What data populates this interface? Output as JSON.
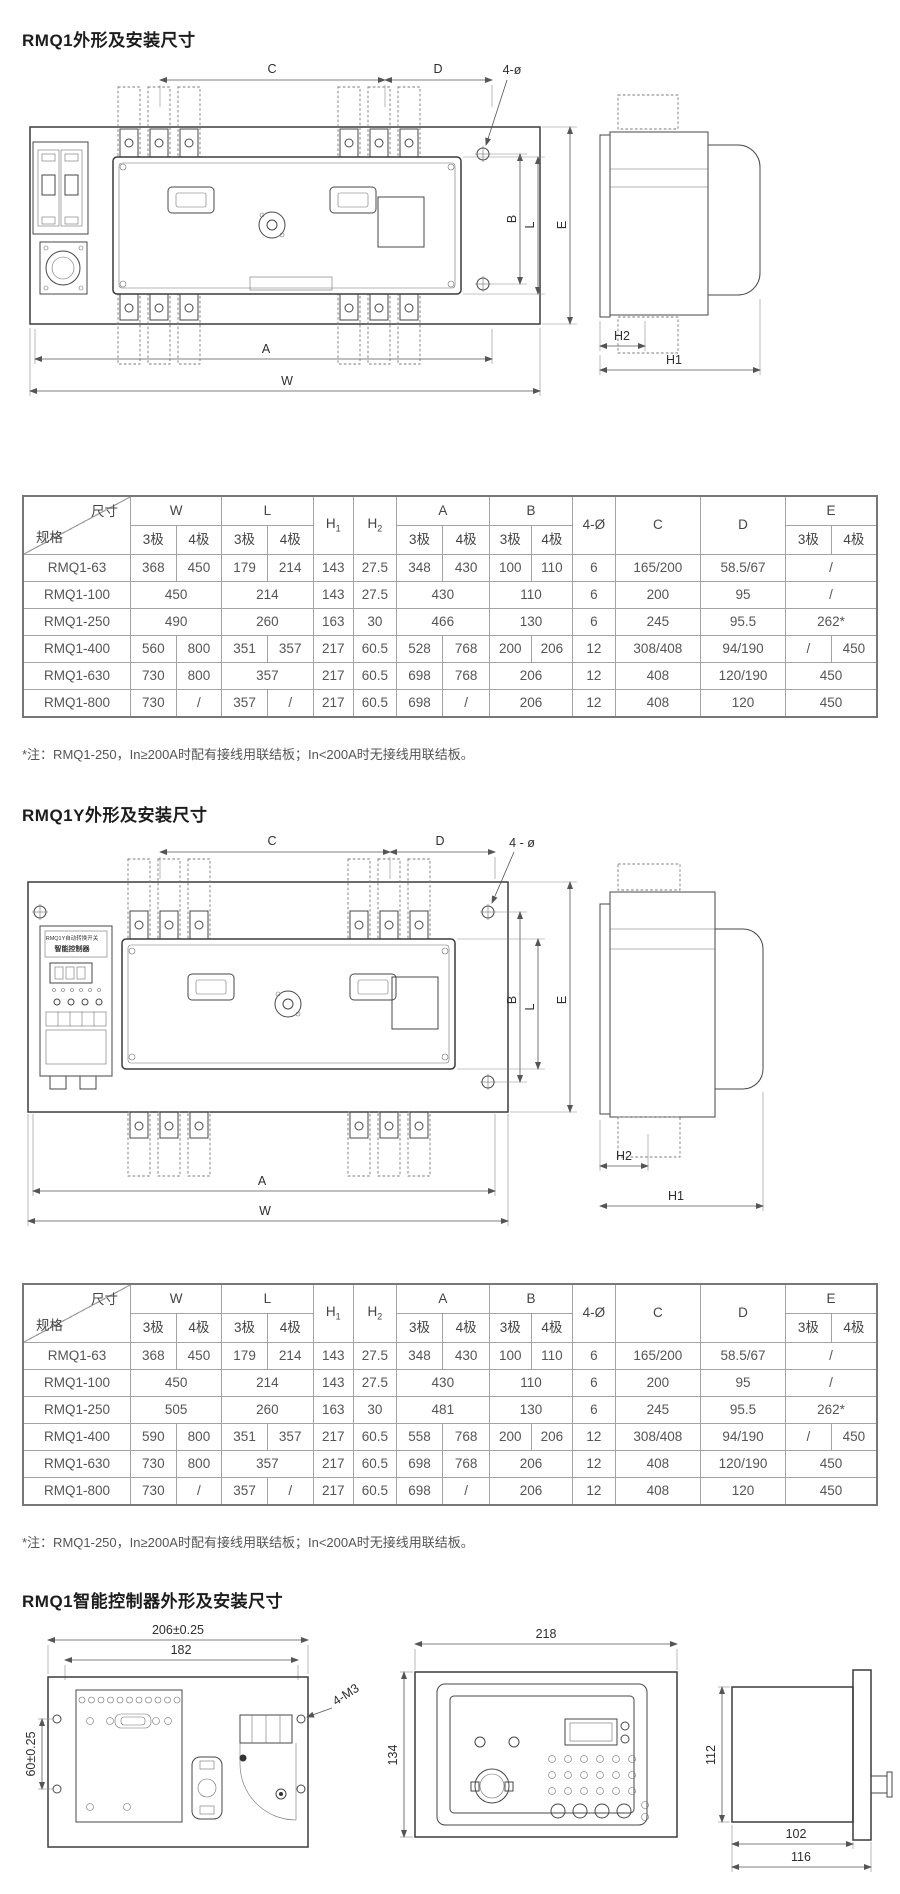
{
  "section1": {
    "title": "RMQ1外形及安装尺寸"
  },
  "section2": {
    "title": "RMQ1Y外形及安装尺寸"
  },
  "section3": {
    "title": "RMQ1智能控制器外形及安装尺寸"
  },
  "note": "*注：RMQ1-250，In≥200A时配有接线用联结板；In<200A时无接线用联结板。",
  "dim_header": {
    "corner_top": "尺寸",
    "corner_bottom": "规格",
    "w": "W",
    "l": "L",
    "h": "H",
    "h1sub": "1",
    "h2sub": "2",
    "a": "A",
    "b": "B",
    "phi": "4-Ø",
    "c": "C",
    "d": "D",
    "e": "E",
    "pole3": "3极",
    "pole4": "4极"
  },
  "tables": {
    "rmq1": {
      "rows": [
        {
          "spec": "RMQ1-63",
          "cells": [
            [
              "368",
              1
            ],
            [
              "450",
              1
            ],
            [
              "179",
              1
            ],
            [
              "214",
              1
            ],
            [
              "143",
              1
            ],
            [
              "27.5",
              1
            ],
            [
              "348",
              1
            ],
            [
              "430",
              1
            ],
            [
              "100",
              1
            ],
            [
              "110",
              1
            ],
            [
              "6",
              1
            ],
            [
              "165/200",
              1
            ],
            [
              "58.5/67",
              1
            ],
            [
              "/",
              2
            ]
          ]
        },
        {
          "spec": "RMQ1-100",
          "cells": [
            [
              "450",
              2
            ],
            [
              "214",
              2
            ],
            [
              "143",
              1
            ],
            [
              "27.5",
              1
            ],
            [
              "430",
              2
            ],
            [
              "110",
              2
            ],
            [
              "6",
              1
            ],
            [
              "200",
              1
            ],
            [
              "95",
              1
            ],
            [
              "/",
              2
            ]
          ]
        },
        {
          "spec": "RMQ1-250",
          "cells": [
            [
              "490",
              2
            ],
            [
              "260",
              2
            ],
            [
              "163",
              1
            ],
            [
              "30",
              1
            ],
            [
              "466",
              2
            ],
            [
              "130",
              2
            ],
            [
              "6",
              1
            ],
            [
              "245",
              1
            ],
            [
              "95.5",
              1
            ],
            [
              "262*",
              2
            ]
          ]
        },
        {
          "spec": "RMQ1-400",
          "cells": [
            [
              "560",
              1
            ],
            [
              "800",
              1
            ],
            [
              "351",
              1
            ],
            [
              "357",
              1
            ],
            [
              "217",
              1
            ],
            [
              "60.5",
              1
            ],
            [
              "528",
              1
            ],
            [
              "768",
              1
            ],
            [
              "200",
              1
            ],
            [
              "206",
              1
            ],
            [
              "12",
              1
            ],
            [
              "308/408",
              1
            ],
            [
              "94/190",
              1
            ],
            [
              "/",
              1
            ],
            [
              "450",
              1
            ]
          ]
        },
        {
          "spec": "RMQ1-630",
          "cells": [
            [
              "730",
              1
            ],
            [
              "800",
              1
            ],
            [
              "357",
              2
            ],
            [
              "217",
              1
            ],
            [
              "60.5",
              1
            ],
            [
              "698",
              1
            ],
            [
              "768",
              1
            ],
            [
              "206",
              2
            ],
            [
              "12",
              1
            ],
            [
              "408",
              1
            ],
            [
              "120/190",
              1
            ],
            [
              "450",
              2
            ]
          ]
        },
        {
          "spec": "RMQ1-800",
          "cells": [
            [
              "730",
              1
            ],
            [
              "/",
              1
            ],
            [
              "357",
              1
            ],
            [
              "/",
              1
            ],
            [
              "217",
              1
            ],
            [
              "60.5",
              1
            ],
            [
              "698",
              1
            ],
            [
              "/",
              1
            ],
            [
              "206",
              2
            ],
            [
              "12",
              1
            ],
            [
              "408",
              1
            ],
            [
              "120",
              1
            ],
            [
              "450",
              2
            ]
          ]
        }
      ]
    },
    "rmq1y": {
      "rows": [
        {
          "spec": "RMQ1-63",
          "cells": [
            [
              "368",
              1
            ],
            [
              "450",
              1
            ],
            [
              "179",
              1
            ],
            [
              "214",
              1
            ],
            [
              "143",
              1
            ],
            [
              "27.5",
              1
            ],
            [
              "348",
              1
            ],
            [
              "430",
              1
            ],
            [
              "100",
              1
            ],
            [
              "110",
              1
            ],
            [
              "6",
              1
            ],
            [
              "165/200",
              1
            ],
            [
              "58.5/67",
              1
            ],
            [
              "/",
              2
            ]
          ]
        },
        {
          "spec": "RMQ1-100",
          "cells": [
            [
              "450",
              2
            ],
            [
              "214",
              2
            ],
            [
              "143",
              1
            ],
            [
              "27.5",
              1
            ],
            [
              "430",
              2
            ],
            [
              "110",
              2
            ],
            [
              "6",
              1
            ],
            [
              "200",
              1
            ],
            [
              "95",
              1
            ],
            [
              "/",
              2
            ]
          ]
        },
        {
          "spec": "RMQ1-250",
          "cells": [
            [
              "505",
              2
            ],
            [
              "260",
              2
            ],
            [
              "163",
              1
            ],
            [
              "30",
              1
            ],
            [
              "481",
              2
            ],
            [
              "130",
              2
            ],
            [
              "6",
              1
            ],
            [
              "245",
              1
            ],
            [
              "95.5",
              1
            ],
            [
              "262*",
              2
            ]
          ]
        },
        {
          "spec": "RMQ1-400",
          "cells": [
            [
              "590",
              1
            ],
            [
              "800",
              1
            ],
            [
              "351",
              1
            ],
            [
              "357",
              1
            ],
            [
              "217",
              1
            ],
            [
              "60.5",
              1
            ],
            [
              "558",
              1
            ],
            [
              "768",
              1
            ],
            [
              "200",
              1
            ],
            [
              "206",
              1
            ],
            [
              "12",
              1
            ],
            [
              "308/408",
              1
            ],
            [
              "94/190",
              1
            ],
            [
              "/",
              1
            ],
            [
              "450",
              1
            ]
          ]
        },
        {
          "spec": "RMQ1-630",
          "cells": [
            [
              "730",
              1
            ],
            [
              "800",
              1
            ],
            [
              "357",
              2
            ],
            [
              "217",
              1
            ],
            [
              "60.5",
              1
            ],
            [
              "698",
              1
            ],
            [
              "768",
              1
            ],
            [
              "206",
              2
            ],
            [
              "12",
              1
            ],
            [
              "408",
              1
            ],
            [
              "120/190",
              1
            ],
            [
              "450",
              2
            ]
          ]
        },
        {
          "spec": "RMQ1-800",
          "cells": [
            [
              "730",
              1
            ],
            [
              "/",
              1
            ],
            [
              "357",
              1
            ],
            [
              "/",
              1
            ],
            [
              "217",
              1
            ],
            [
              "60.5",
              1
            ],
            [
              "698",
              1
            ],
            [
              "/",
              1
            ],
            [
              "206",
              2
            ],
            [
              "12",
              1
            ],
            [
              "408",
              1
            ],
            [
              "120",
              1
            ],
            [
              "450",
              2
            ]
          ]
        }
      ]
    }
  },
  "drawing1": {
    "dims": {
      "c": "C",
      "d": "D",
      "holes": "4-ø",
      "b": "B",
      "l": "L",
      "e": "E",
      "a": "A",
      "w": "W",
      "h1": "H1",
      "h2": "H2"
    }
  },
  "drawing2": {
    "dims": {
      "c": "C",
      "d": "D",
      "holes": "4 - ø",
      "b": "B",
      "l": "L",
      "e": "E",
      "a": "A",
      "w": "W",
      "h1": "H1",
      "h2": "H2"
    },
    "controller": {
      "line1": "RMQ1Y自动转换开关",
      "line2": "智能控制器"
    }
  },
  "drawing3": {
    "dims": {
      "width_outer": "206±0.25",
      "width_inner": "182",
      "height_side": "60±0.25",
      "screws": "4-M3",
      "front_width": "218",
      "front_height": "134",
      "side_height": "112",
      "depth_body": "102",
      "depth_total": "116"
    }
  }
}
